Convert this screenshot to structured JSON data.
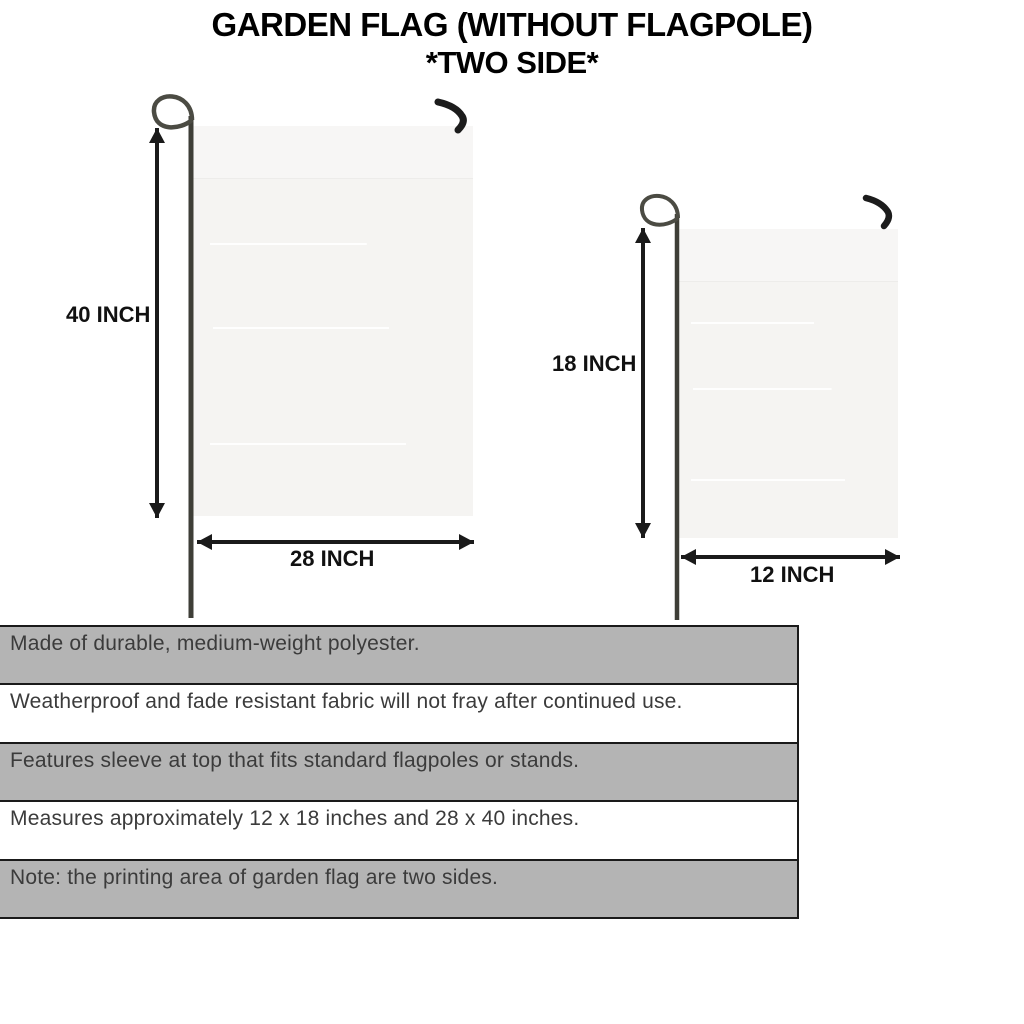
{
  "title": {
    "line1": "GARDEN FLAG (WITHOUT FLAGPOLE)",
    "line2": "*TWO SIDE*"
  },
  "diagram": {
    "large_flag": {
      "height_label": "40 INCH",
      "width_label": "28 INCH"
    },
    "small_flag": {
      "height_label": "18 INCH",
      "width_label": "12 INCH"
    }
  },
  "features_table": {
    "rows": [
      {
        "text": "Made of durable, medium-weight polyester.",
        "shaded": true
      },
      {
        "text": "Weatherproof and fade resistant fabric will not fray after continued use.",
        "shaded": false
      },
      {
        "text": "Features sleeve at top that fits standard flagpoles or stands.",
        "shaded": true
      },
      {
        "text": "Measures approximately 12 x 18 inches and 28 x 40 inches.",
        "shaded": false
      },
      {
        "text": "Note: the printing area of garden flag are two sides.",
        "shaded": true
      }
    ]
  },
  "colors": {
    "row_shaded": "#b4b4b4",
    "row_plain": "#ffffff",
    "table_border": "#1a1a1a",
    "table_text": "#3b3b3b",
    "flag_fill": "#f5f4f2",
    "pole": "#3e3e37",
    "hook": "#1c1c1c",
    "arrow": "#1a1a1a",
    "title_text": "#000000"
  }
}
